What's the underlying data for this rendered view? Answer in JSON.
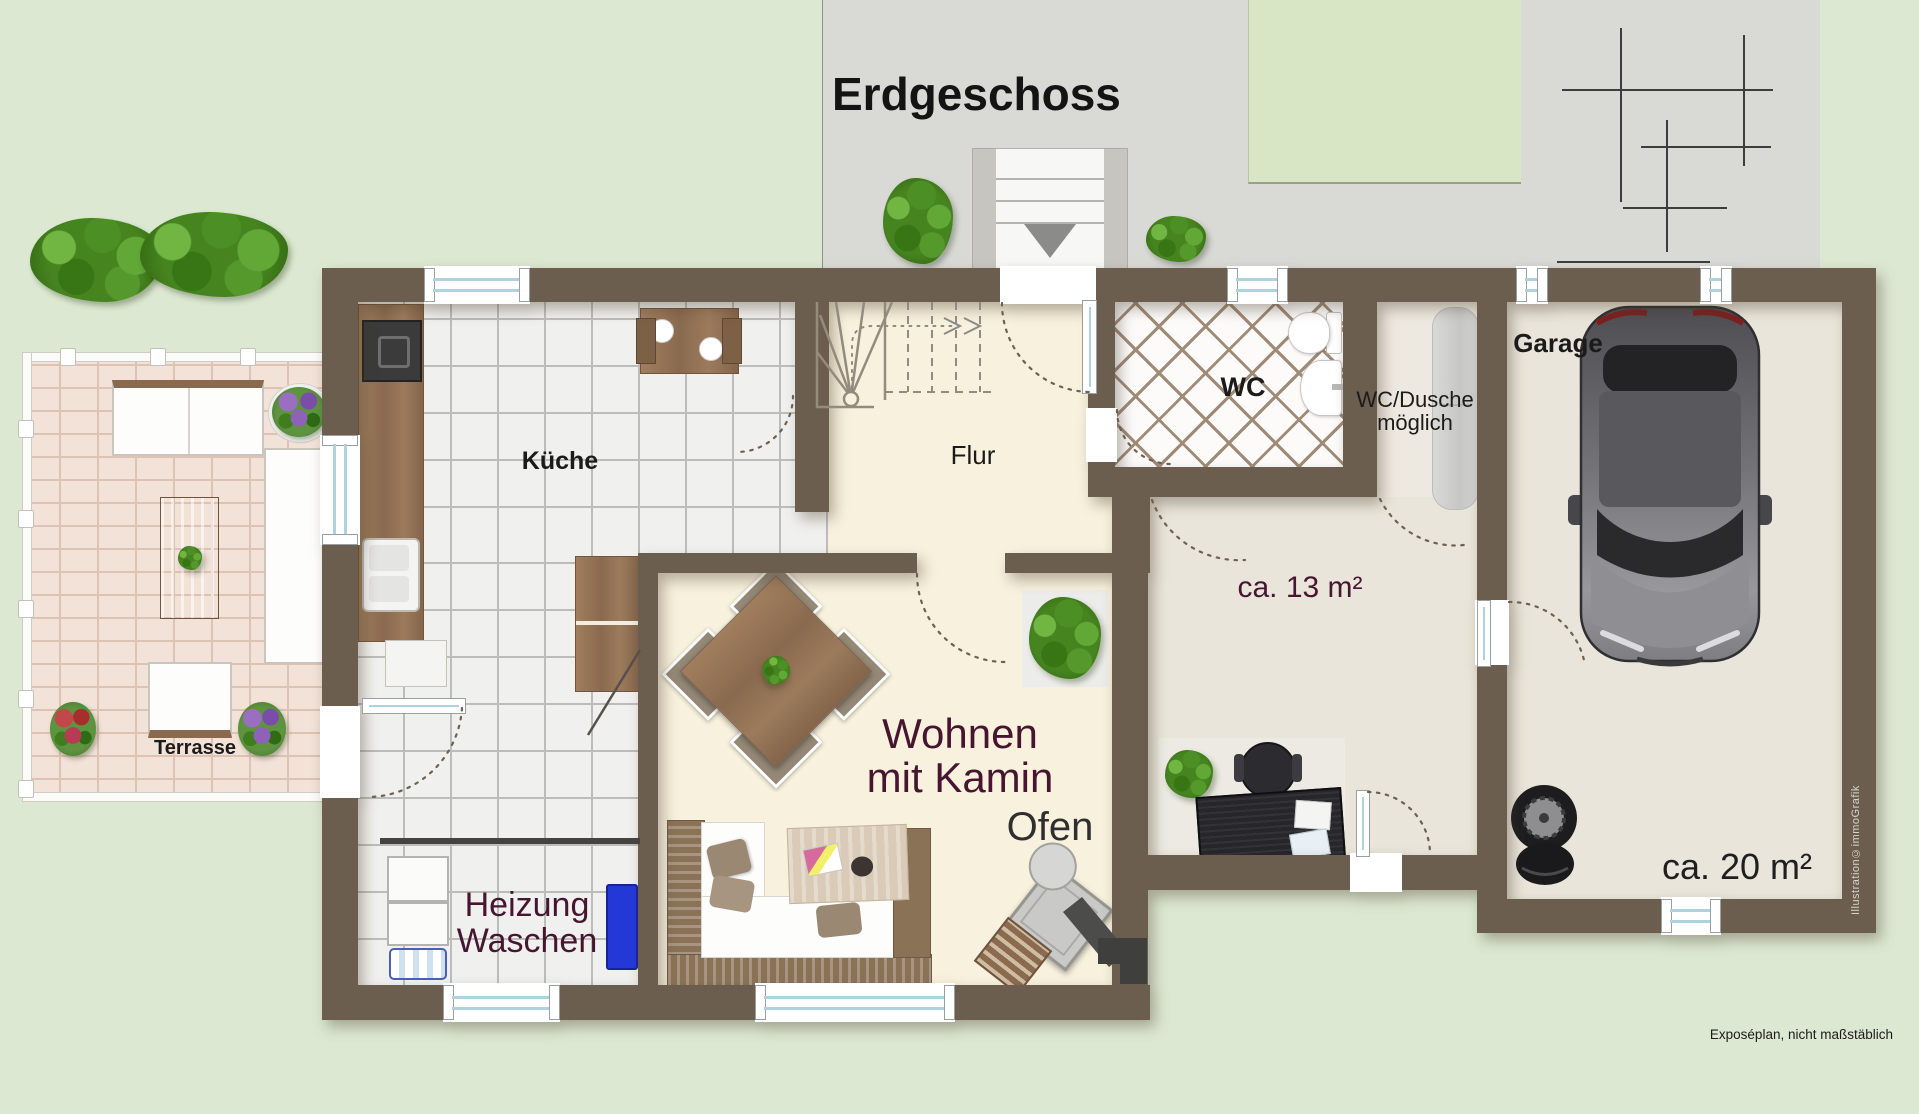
{
  "title": "Erdgeschoss",
  "rooms": {
    "kitchen": {
      "label": "Küche"
    },
    "hallway": {
      "label": "Flur"
    },
    "wc": {
      "label": "WC"
    },
    "wc_shower": {
      "line1": "WC/Dusche",
      "line2": "möglich"
    },
    "garage": {
      "label": "Garage",
      "area": "ca. 20 m²"
    },
    "room13": {
      "area": "ca. 13 m²"
    },
    "living": {
      "line1": "Wohnen",
      "line2": "mit Kamin",
      "stove_label": "Ofen"
    },
    "utility": {
      "line1": "Heizung",
      "line2": "Waschen"
    },
    "terrace": {
      "label": "Terrasse"
    }
  },
  "notes": {
    "disclaimer": "Exposéplan, nicht maßstäblich",
    "credit": "Illustration©immoGrafik"
  },
  "colors": {
    "background_green": "#dce8d2",
    "background_gray": "#d9d9d6",
    "wall": "#6c5e4f",
    "floor_cream": "#f8f1dd",
    "floor_tile": "#f0f0ee",
    "floor_wc": "#fcfbfa",
    "floor_garage": "#e9e5da",
    "terrace_brick": "#f2e2d8",
    "window_glass": "#aed2de",
    "label_dark": "#1b1b1b",
    "label_maroon": "#461631"
  }
}
